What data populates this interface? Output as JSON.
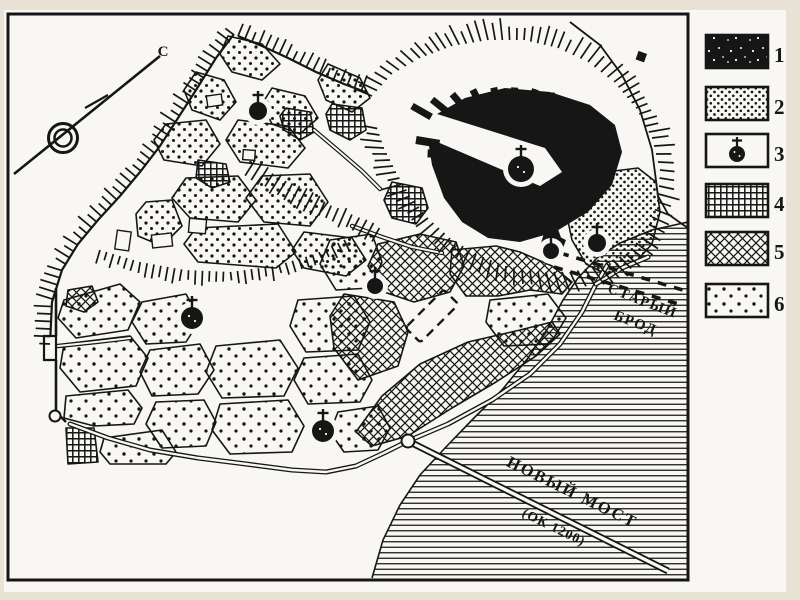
{
  "colors": {
    "background": "#e8e2d5",
    "paper": "#f8f7f3",
    "ink": "#161616"
  },
  "north_marker": {
    "label": "С"
  },
  "map_labels": {
    "old_ford_line1": "СТАРЫЙ",
    "old_ford_line2": "БРОД",
    "new_bridge_name": "НОВЫЙ МОСТ",
    "new_bridge_date": "(ОК 1200)"
  },
  "legend": {
    "items": [
      {
        "number": "1",
        "symbol": "solid-black-fill"
      },
      {
        "number": "2",
        "symbol": "dense-stipple"
      },
      {
        "number": "3",
        "symbol": "church-circle-with-cross"
      },
      {
        "number": "4",
        "symbol": "orthogonal-grid-hatch"
      },
      {
        "number": "5",
        "symbol": "diagonal-crosshatch"
      },
      {
        "number": "6",
        "symbol": "sparse-stipple"
      }
    ]
  }
}
